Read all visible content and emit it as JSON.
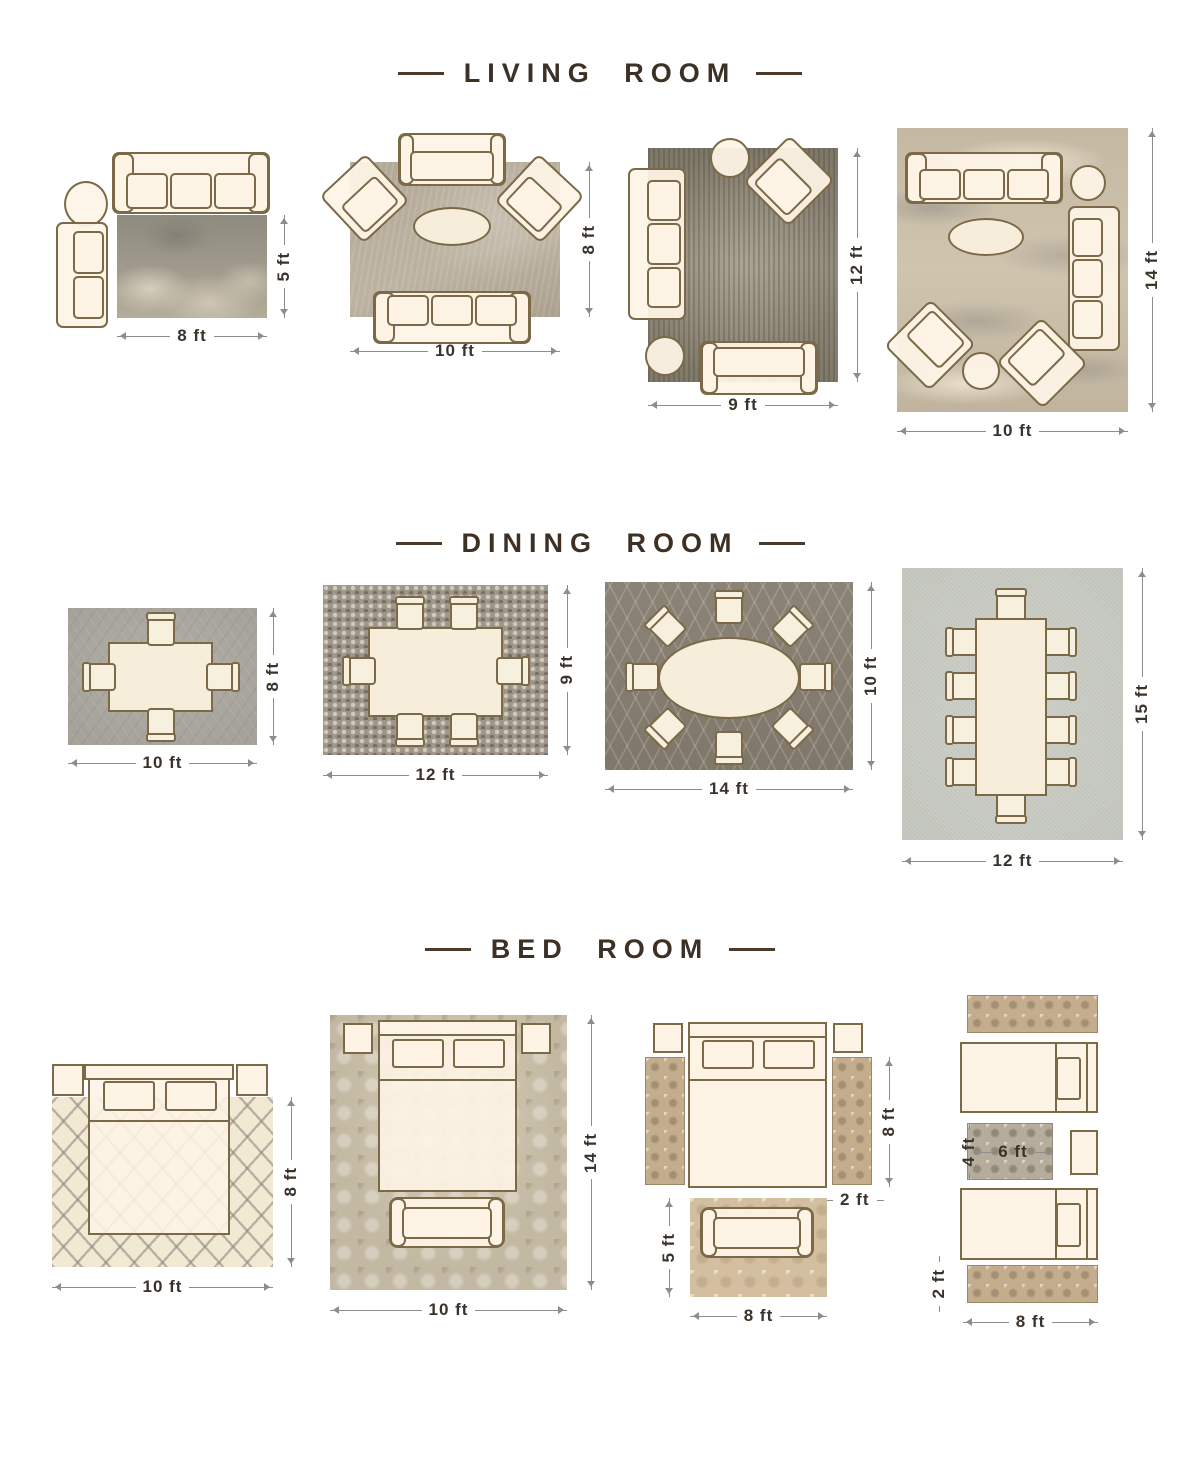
{
  "palette": {
    "title_color": "#3d3024",
    "dimension_text_color": "#3a332b",
    "dimension_line_color": "#8f8d87",
    "furniture_fill": "#fdf4e6",
    "furniture_outline": "#7b6947"
  },
  "sections": {
    "living": {
      "title": "LIVING ROOM"
    },
    "dining": {
      "title": "DINING ROOM"
    },
    "bedroom": {
      "title": "BED ROOM"
    }
  },
  "living_layouts": [
    {
      "width": "8 ft",
      "height": "5 ft"
    },
    {
      "width": "10 ft",
      "height": "8 ft"
    },
    {
      "width": "9 ft",
      "height": "12 ft"
    },
    {
      "width": "10 ft",
      "height": "14 ft"
    }
  ],
  "dining_layouts": [
    {
      "width": "10 ft",
      "height": "8 ft"
    },
    {
      "width": "12 ft",
      "height": "9 ft"
    },
    {
      "width": "14 ft",
      "height": "10 ft"
    },
    {
      "width": "12 ft",
      "height": "15 ft"
    }
  ],
  "bedroom_layouts": [
    {
      "width": "10 ft",
      "height": "8 ft"
    },
    {
      "width": "10 ft",
      "height": "14 ft"
    },
    {
      "bed_height": "8 ft",
      "runner_width": "2 ft",
      "foot_rug_height": "5 ft",
      "foot_rug_width": "8 ft"
    },
    {
      "accent_rug_height": "4 ft",
      "accent_rug_width": "6 ft",
      "runner_height": "2 ft",
      "width": "8 ft"
    }
  ]
}
